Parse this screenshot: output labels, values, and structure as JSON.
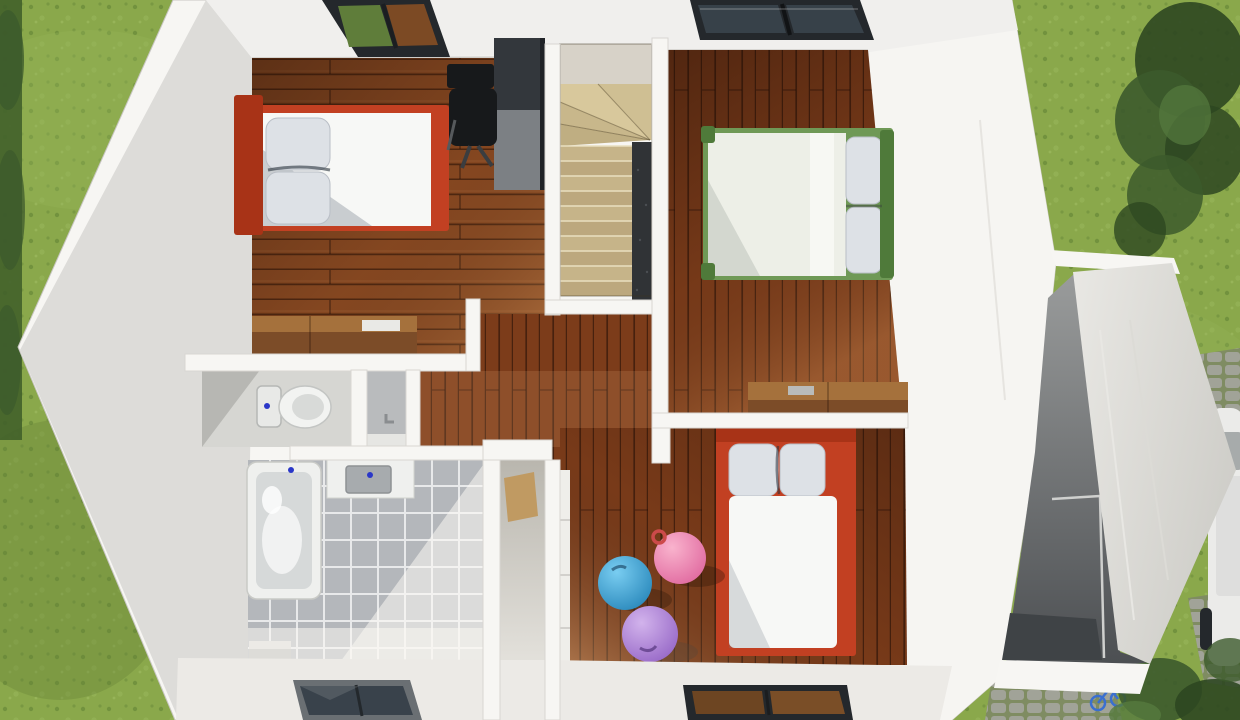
{
  "scene": {
    "title": "3D top-down floor plan render of an upper storey with two double bedrooms, a child bedroom with gym balls, bathroom with WC, winder staircase, landing, attached garage, lawn, tree, paver driveway and a white car at the right edge",
    "view": "top-down 3d cutaway",
    "floor_label": "upper floor"
  },
  "palette": {
    "grass": "#8aa84b",
    "grass_light": "#9cbb58",
    "grass_dark": "#73933c",
    "hedge": "#41602a",
    "tree": "#3c5a2c",
    "tree_dark": "#2d4721",
    "wall": "#f7f6f3",
    "wall_face": "#dddcd9",
    "wall_bright": "#f6f5f2",
    "roof_band": "#f0efed",
    "wood_mid": "#8a4a22",
    "wood_dark": "#7c3c1a",
    "furniture_wood": "#7c4c28",
    "furniture_wood_top": "#a5713c",
    "bed_red": "#c24022",
    "bed_red_dark": "#a83317",
    "mattress": "#f7f8f6",
    "pillow": "#dde1e6",
    "bed_green": "#6f9956",
    "bed_green_dark": "#4f7a3a",
    "duvet": "#edefe7",
    "tile": "#b4b7bb",
    "tile_grout": "#e8e9ea",
    "tub": "#eff0ee",
    "tub_inner": "#d6d9d9",
    "basin": "#a7abae",
    "drain_blue": "#2a37c8",
    "stair_landing": "#d7d2c8",
    "stair_tread": "#c6b489",
    "stair_tread_dark": "#bca87e",
    "stair_pit": "#303336",
    "glass_dark": "#39424b",
    "glass_brown": "#6d4522",
    "frame_dark": "#24282c",
    "ball_blue": "#2f9bd6",
    "ball_pink": "#ef6fa7",
    "ball_purple": "#a878d8",
    "paver": "#a4a59c",
    "paver_bg": "#7f8c62",
    "terrace_dark": "#55585a",
    "terrace_floor": "#3f4346",
    "corridor_floor": "#dedbd3",
    "desk_dark": "#33373c",
    "desk_mid": "#7c8084",
    "chair_black": "#17191b",
    "door_tan": "#c09a62",
    "floor_white": "#eceae6",
    "car_white": "#ebebe9",
    "wc_floor": "#d6d6d2",
    "stall_floor": "#b9bbbd",
    "bike_blue": "#3a6fd0"
  },
  "rooms": [
    {
      "id": "bedroom-1",
      "position": "top-left",
      "floor": "wood plank",
      "furniture": [
        "double bed, red frame, white mattress, grey pillows",
        "dark desk with laptop",
        "black office chair",
        "wooden sideboard"
      ]
    },
    {
      "id": "bedroom-2",
      "position": "top-right",
      "floor": "wood plank",
      "furniture": [
        "double bed, green frame, white duvet, two pillows",
        "wooden dresser"
      ]
    },
    {
      "id": "bedroom-3",
      "position": "bottom-right",
      "floor": "wood plank",
      "furniture": [
        "bed, red frame, white mattress, two grey pillows",
        "tan wardrobe door",
        "blue gym ball",
        "pink gym ball",
        "purple gym ball"
      ]
    },
    {
      "id": "bathroom",
      "position": "bottom-left",
      "floor": "grey tile",
      "furniture": [
        "bathtub",
        "vanity sink",
        "shower stall"
      ]
    },
    {
      "id": "wc",
      "position": "mid-left",
      "furniture": [
        "toilet"
      ]
    },
    {
      "id": "stairwell",
      "position": "top-center",
      "detail": "winder staircase with dark stair void"
    },
    {
      "id": "hallway",
      "position": "center",
      "floor": "wood plank"
    }
  ],
  "exterior": [
    "lawn",
    "hedge along left edge",
    "tree top-right",
    "attached garage with slanted roof at right",
    "dark terrace with railing",
    "paver driveway",
    "white car at right edge",
    "blue bicycle bottom-right",
    "shrubs bottom-right"
  ],
  "skylights": [
    {
      "id": "skylight-1",
      "over": "bedroom-1"
    },
    {
      "id": "skylight-2",
      "over": "bedroom-2"
    },
    {
      "id": "skylight-3",
      "over": "bathroom floor band"
    },
    {
      "id": "skylight-4",
      "over": "bedroom-3 floor band"
    }
  ]
}
